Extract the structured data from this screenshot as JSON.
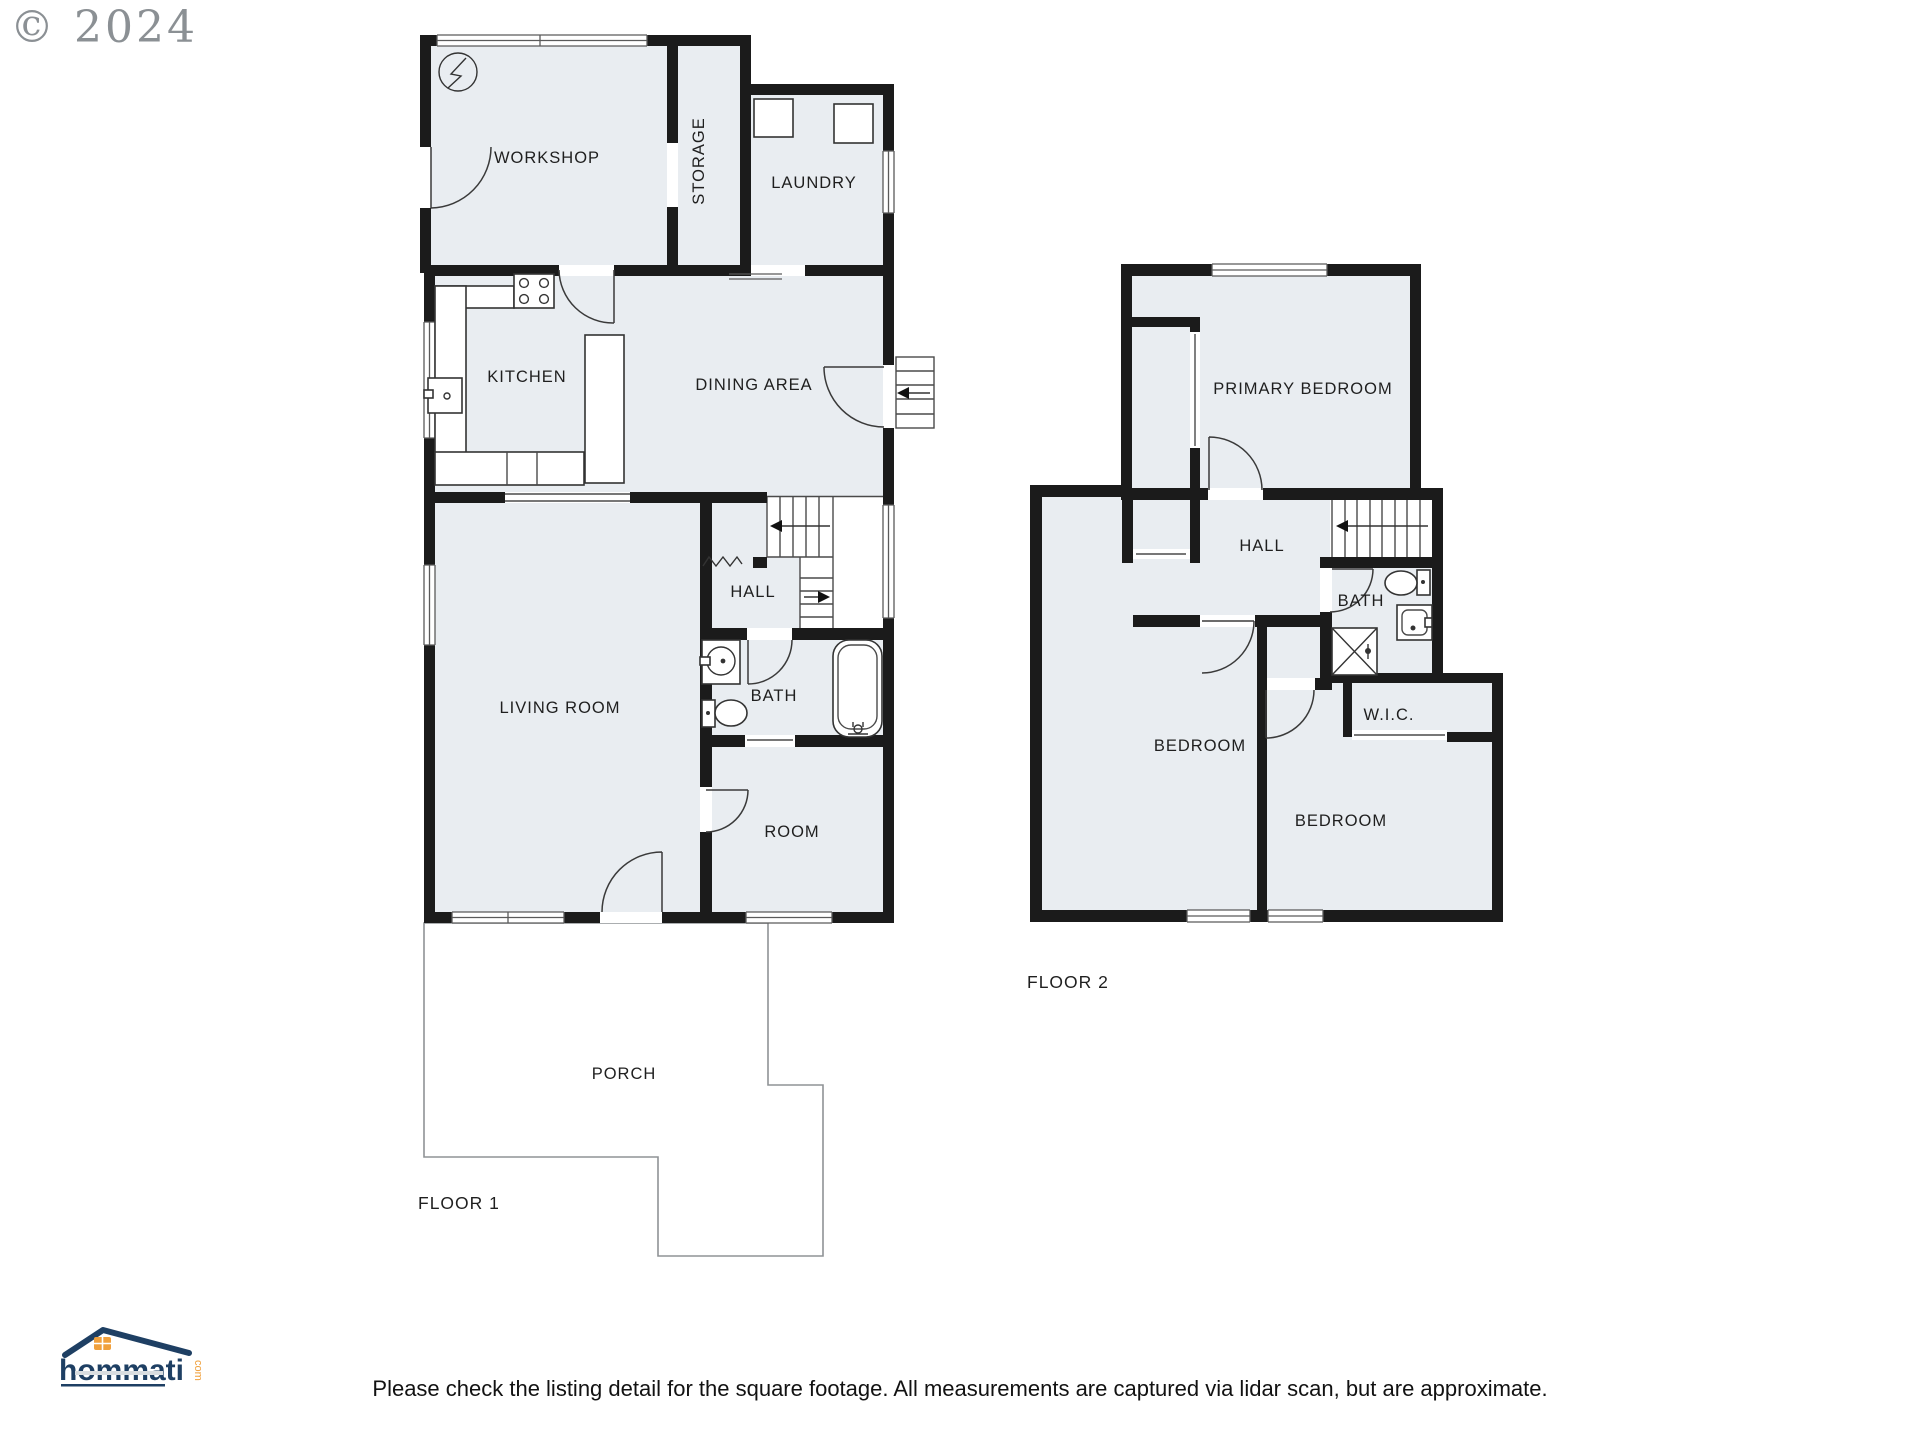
{
  "copyright": "© 2024",
  "disclaimer": "Please check the listing detail for the square footage. All measurements are captured via lidar scan, but are approximate.",
  "logo": {
    "brand": "hommati",
    "tld": "com"
  },
  "floor1": {
    "label": "FLOOR 1",
    "rooms": {
      "workshop": "WORKSHOP",
      "storage": "STORAGE",
      "laundry": "LAUNDRY",
      "kitchen": "KITCHEN",
      "dining": "DINING AREA",
      "hall": "HALL",
      "living": "LIVING ROOM",
      "bath": "BATH",
      "room": "ROOM",
      "porch": "PORCH"
    }
  },
  "floor2": {
    "label": "FLOOR 2",
    "rooms": {
      "primary": "PRIMARY BEDROOM",
      "hall": "HALL",
      "bath": "BATH",
      "wic": "W.I.C.",
      "bedroom_left": "BEDROOM",
      "bedroom_right": "BEDROOM"
    }
  },
  "colors": {
    "wall": "#1b1b1b",
    "room_fill": "#e9edf1",
    "logo_navy": "#1e3f63",
    "logo_orange": "#f0a03c"
  }
}
